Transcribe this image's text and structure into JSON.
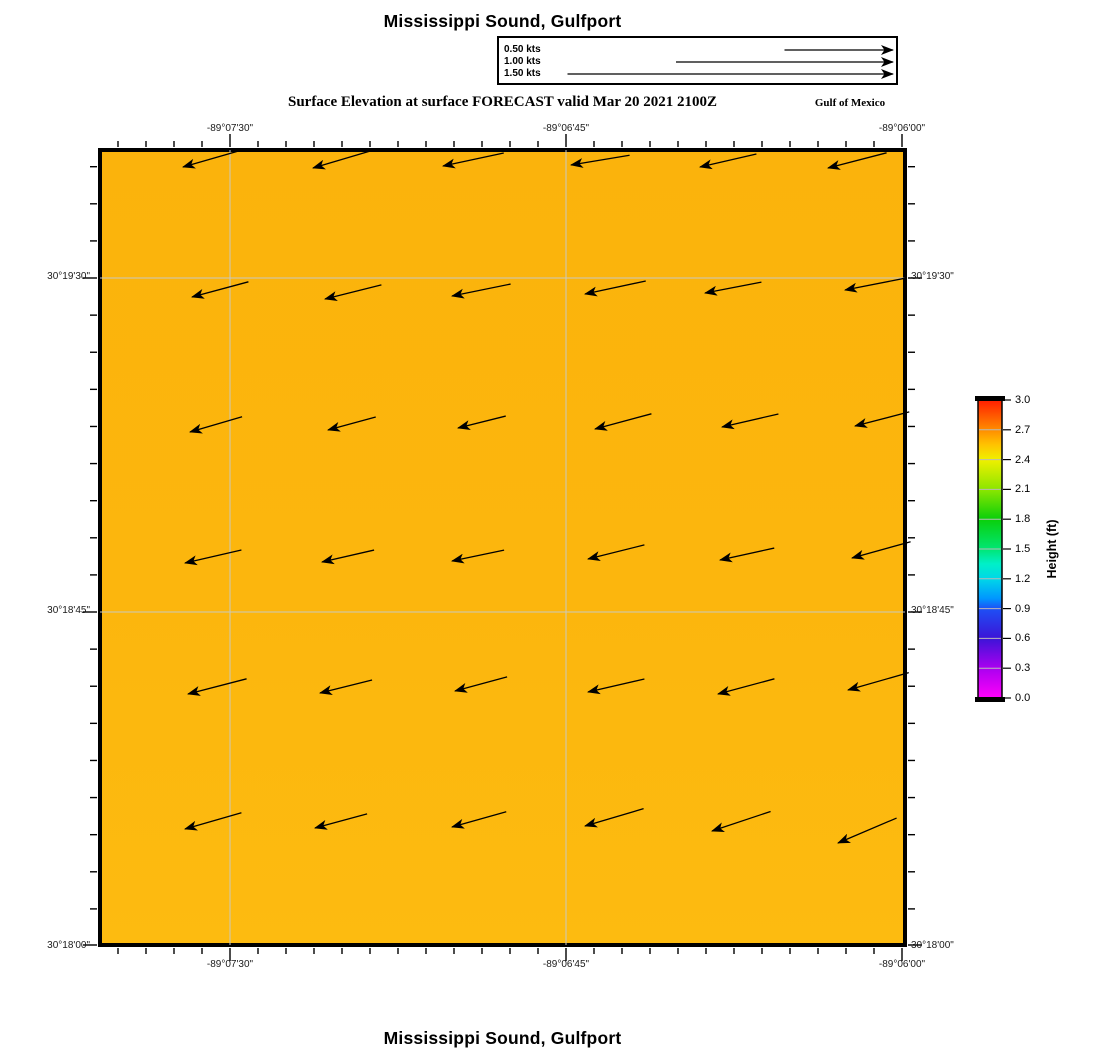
{
  "header": {
    "title": "Mississippi Sound, Gulfport",
    "subtitle": "Surface Elevation at surface FORECAST valid Mar 20 2021 2100Z",
    "region_label": "Gulf of Mexico"
  },
  "footer": {
    "title": "Mississippi Sound, Gulfport"
  },
  "legend": {
    "entries": [
      {
        "label": "0.50 kts",
        "kts": 0.5
      },
      {
        "label": "1.00 kts",
        "kts": 1.0
      },
      {
        "label": "1.50 kts",
        "kts": 1.5
      }
    ]
  },
  "axes": {
    "top": [
      "-89°07'30\"",
      "-89°06'45\"",
      "-89°06'00\""
    ],
    "bottom": [
      "-89°07'30\"",
      "-89°06'45\"",
      "-89°06'00\""
    ],
    "left": [
      "30°19'30\"",
      "30°18'45\"",
      "30°18'00\""
    ],
    "right": [
      "30°19'30\"",
      "30°18'45\"",
      "30°18'00\""
    ]
  },
  "colorbar": {
    "title": "Height (ft)",
    "min": 0.0,
    "max": 3.0,
    "tick_values": [
      3.0,
      2.7,
      2.4,
      2.1,
      1.8,
      1.5,
      1.2,
      0.9,
      0.6,
      0.3,
      0.0
    ],
    "tick_labels": [
      "3.0",
      "2.7",
      "2.4",
      "2.1",
      "1.8",
      "1.5",
      "1.2",
      "0.9",
      "0.6",
      "0.3",
      "0.0"
    ],
    "px": {
      "x": 978,
      "y": 400,
      "width": 24,
      "height": 298
    },
    "stops": [
      {
        "v": 3.0,
        "color": "#FF1E00"
      },
      {
        "v": 2.7,
        "color": "#FF8C00"
      },
      {
        "v": 2.55,
        "color": "#FFC300"
      },
      {
        "v": 2.4,
        "color": "#F0F000"
      },
      {
        "v": 2.1,
        "color": "#8CE600"
      },
      {
        "v": 1.8,
        "color": "#0ACF0A"
      },
      {
        "v": 1.5,
        "color": "#00E673"
      },
      {
        "v": 1.35,
        "color": "#00F0C8"
      },
      {
        "v": 1.2,
        "color": "#00D7E8"
      },
      {
        "v": 1.0,
        "color": "#0096FF"
      },
      {
        "v": 0.9,
        "color": "#1E50F5"
      },
      {
        "v": 0.6,
        "color": "#3C14D7"
      },
      {
        "v": 0.3,
        "color": "#AA00F0"
      },
      {
        "v": 0.0,
        "color": "#FF00FA"
      }
    ]
  },
  "chart_data": {
    "type": "vector-field-map",
    "title": "Mississippi Sound, Gulfport",
    "field": "Surface Elevation",
    "level": "at surface",
    "mode": "FORECAST",
    "valid_time": "Mar 20 2021 2100Z",
    "region": "Gulf of Mexico",
    "surface_elevation_ft_approx": 2.5,
    "fill_gradient": [
      {
        "offset": "0%",
        "color": "#FBB30C"
      },
      {
        "offset": "55%",
        "color": "#FCB60D"
      },
      {
        "offset": "100%",
        "color": "#FDBB10"
      }
    ],
    "grid_color": "#C9C9BF",
    "plot_px": {
      "left": 100,
      "top": 150,
      "width": 805,
      "height": 795
    },
    "x_axis": {
      "labels": [
        "-89°07'30\"",
        "-89°06'45\"",
        "-89°06'00\""
      ],
      "px": [
        230,
        566,
        902
      ],
      "minor_start_px": 118,
      "minor_step_px": 28
    },
    "y_axis": {
      "labels": [
        "30°19'30\"",
        "30°18'45\"",
        "30°18'00\""
      ],
      "px": [
        278,
        612,
        945
      ],
      "minor_start_px": 166.7,
      "minor_step_px": 37.11
    },
    "legend_px": {
      "end_x": 893,
      "rows_y": [
        50,
        62,
        74
      ]
    },
    "arrows": {
      "units": "kts",
      "speed_scale_px_per_kt": 217,
      "grid": [
        [
          183,
          167,
          -0.26,
          -0.075
        ],
        [
          313,
          168,
          -0.27,
          -0.08
        ],
        [
          443,
          166,
          -0.28,
          -0.06
        ],
        [
          571,
          165,
          -0.27,
          -0.045
        ],
        [
          700,
          167,
          -0.26,
          -0.06
        ],
        [
          828,
          168,
          -0.27,
          -0.07
        ],
        [
          192,
          297,
          -0.26,
          -0.07
        ],
        [
          325,
          299,
          -0.26,
          -0.065
        ],
        [
          452,
          296,
          -0.27,
          -0.055
        ],
        [
          585,
          294,
          -0.28,
          -0.06
        ],
        [
          705,
          293,
          -0.26,
          -0.05
        ],
        [
          845,
          290,
          -0.28,
          -0.055
        ],
        [
          190,
          432,
          -0.24,
          -0.07
        ],
        [
          328,
          430,
          -0.22,
          -0.06
        ],
        [
          458,
          428,
          -0.22,
          -0.055
        ],
        [
          595,
          429,
          -0.26,
          -0.07
        ],
        [
          722,
          427,
          -0.26,
          -0.06
        ],
        [
          855,
          426,
          -0.25,
          -0.065
        ],
        [
          185,
          563,
          -0.26,
          -0.06
        ],
        [
          322,
          562,
          -0.24,
          -0.055
        ],
        [
          452,
          561,
          -0.24,
          -0.05
        ],
        [
          588,
          559,
          -0.26,
          -0.065
        ],
        [
          720,
          560,
          -0.25,
          -0.055
        ],
        [
          852,
          558,
          -0.27,
          -0.075
        ],
        [
          188,
          694,
          -0.27,
          -0.07
        ],
        [
          320,
          693,
          -0.24,
          -0.06
        ],
        [
          455,
          691,
          -0.24,
          -0.065
        ],
        [
          588,
          692,
          -0.26,
          -0.06
        ],
        [
          718,
          694,
          -0.26,
          -0.07
        ],
        [
          848,
          690,
          -0.28,
          -0.08
        ],
        [
          185,
          829,
          -0.26,
          -0.075
        ],
        [
          315,
          828,
          -0.24,
          -0.065
        ],
        [
          452,
          827,
          -0.25,
          -0.07
        ],
        [
          585,
          826,
          -0.27,
          -0.08
        ],
        [
          712,
          831,
          -0.27,
          -0.09
        ],
        [
          838,
          843,
          -0.27,
          -0.115
        ]
      ]
    }
  }
}
